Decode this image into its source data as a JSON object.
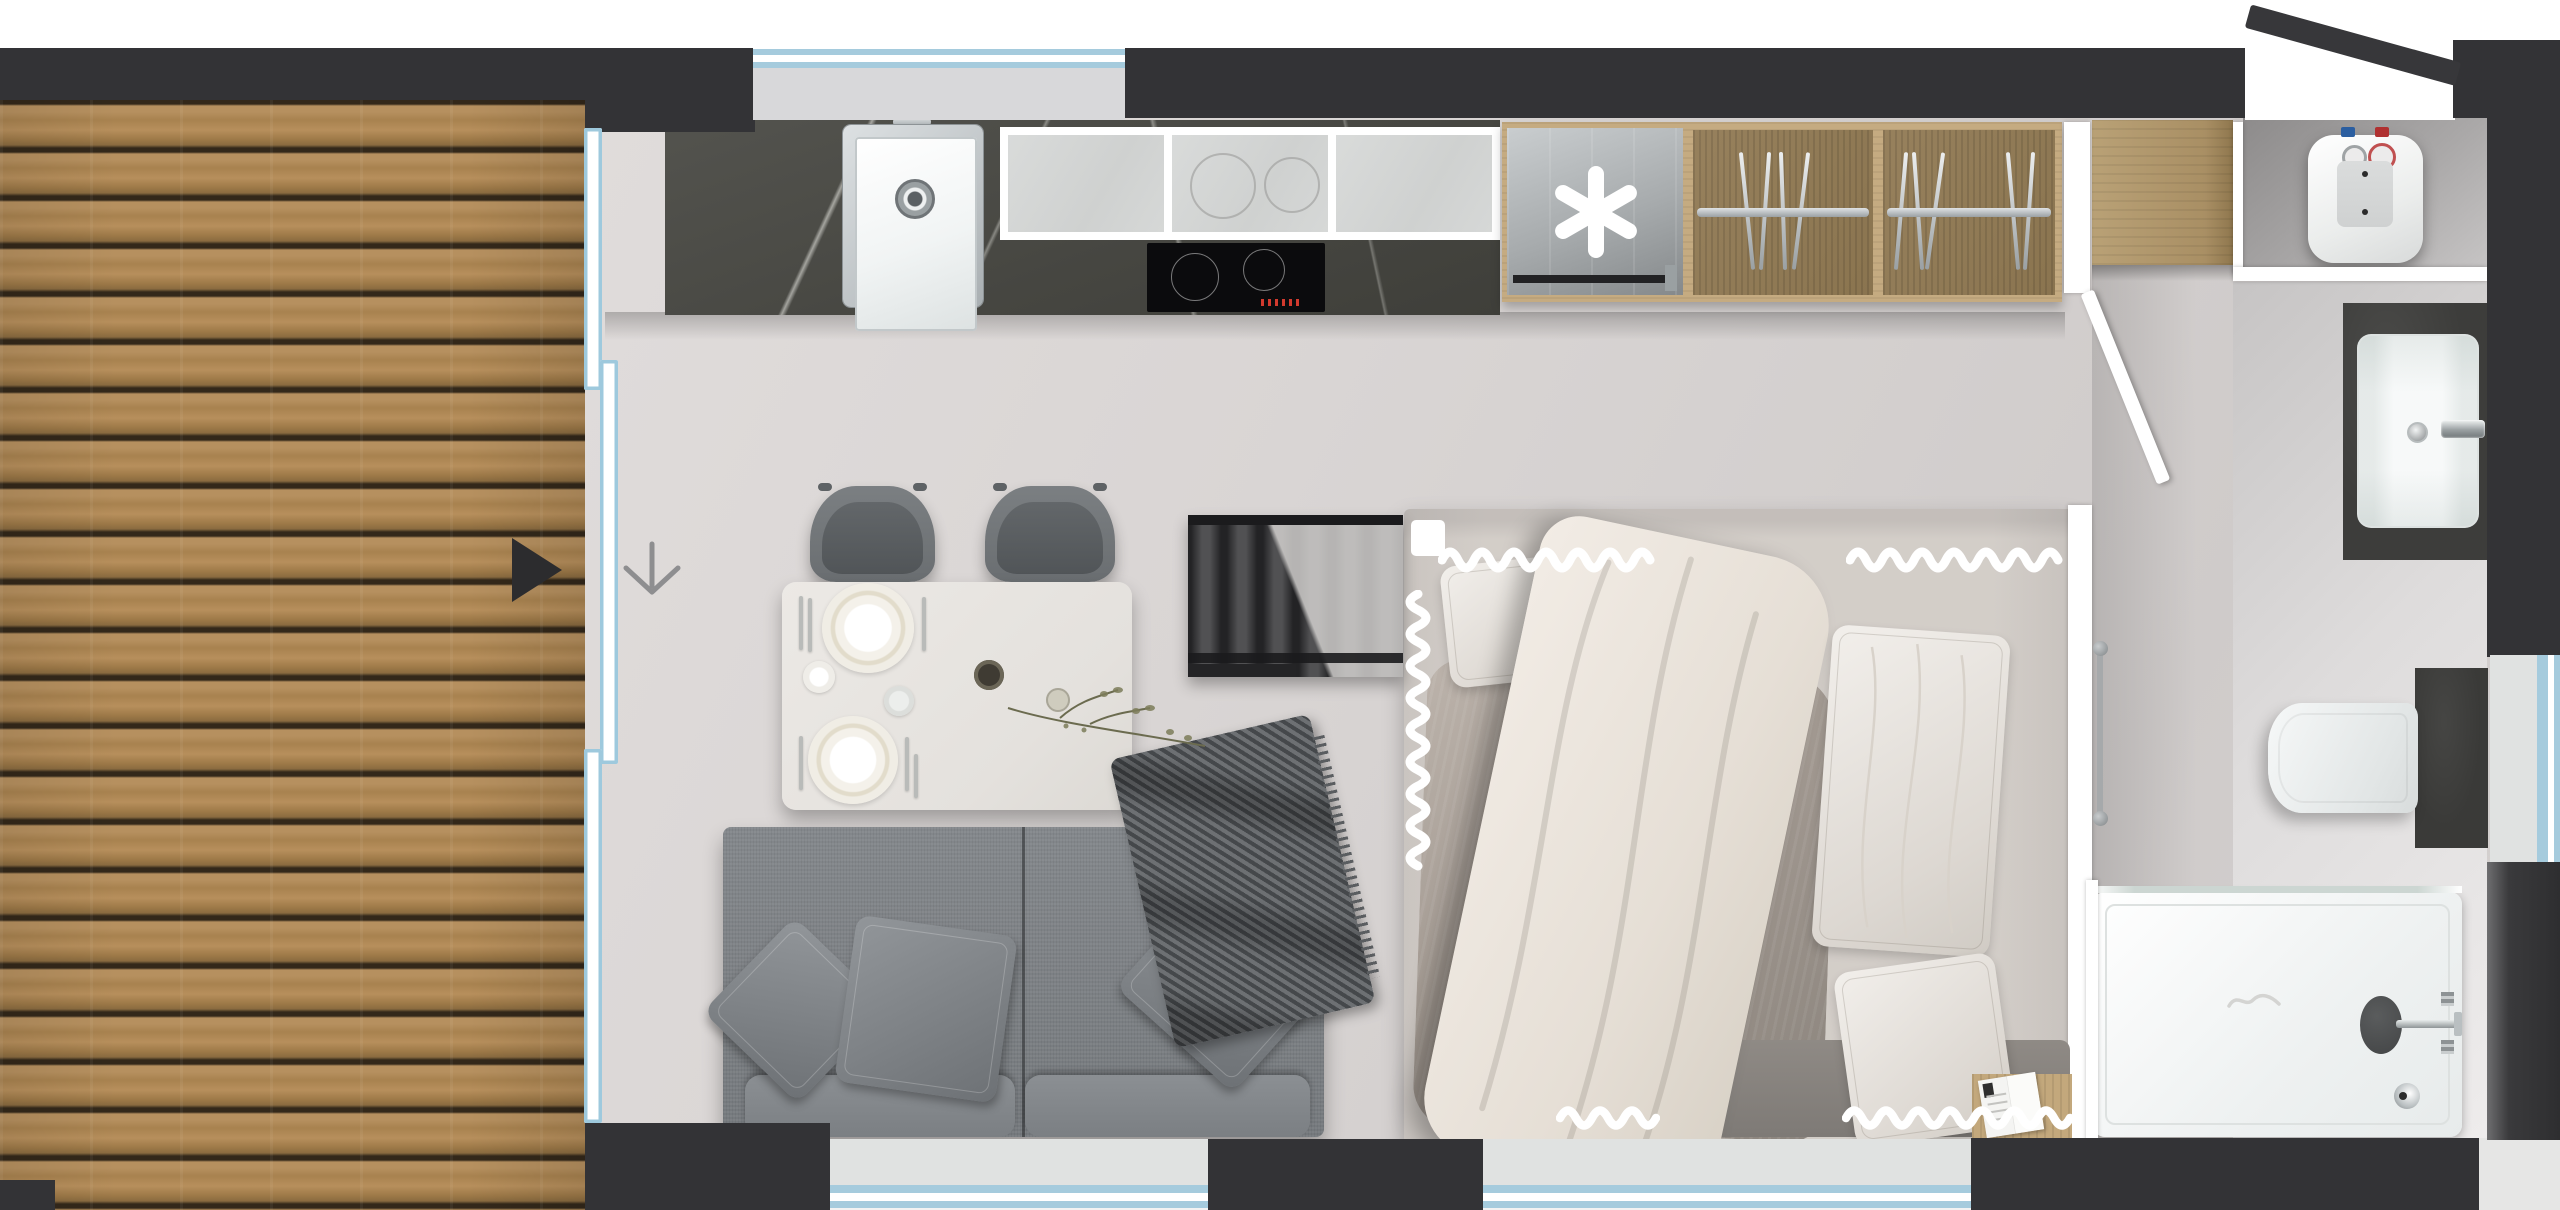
{
  "scene": {
    "type": "apartment-floor-plan-render",
    "view": "top-down",
    "width_px": 2560,
    "height_px": 1210,
    "visible_text": "none"
  },
  "colors": {
    "wall": "#333336",
    "window_accent": "#a5cbdd",
    "window_sill": "#dfe1e0",
    "deck_plank": "#b6905f",
    "deck_gap": "#33281a",
    "floor": "#dbd7d5",
    "counter_marble": "#464641",
    "backsplash_panel": "#d3d5d4",
    "hob": "#0b0b0d",
    "stainless": "#c8ccce",
    "cabinet_wood": "#c5ab81",
    "wardrobe_back": "#97815d",
    "sofa": "#7d8185",
    "chair": "#73777a",
    "table": "#e9e6e2",
    "bed_sheet": "#e7e4e1",
    "duvet": "#ece6de",
    "bed_blanket": "#a39a92",
    "radiator": "#232325",
    "bath_fixture_dark": "#3d3d3b",
    "shower_tray": "#f4f6f6",
    "white": "#ffffff"
  },
  "icons": {
    "appliance_symbol": {
      "name": "six-arm-asterisk-icon",
      "glyph": "✱"
    },
    "entry_arrow": {
      "name": "entry-arrow-icon",
      "glyph": "▶"
    },
    "walk_direction_arrow": {
      "name": "down-arrow-icon",
      "glyph": "↓"
    }
  },
  "rooms": [
    {
      "label": "terrace-deck"
    },
    {
      "label": "living-kitchen-area"
    },
    {
      "label": "sleeping-area"
    },
    {
      "label": "hallway"
    },
    {
      "label": "bathroom"
    },
    {
      "label": "water-heater-closet"
    }
  ],
  "fixtures": [
    {
      "label": "kitchen-counter-marble"
    },
    {
      "label": "undermount-sink"
    },
    {
      "label": "induction-hob"
    },
    {
      "label": "glass-backsplash-panels"
    },
    {
      "label": "dishwasher-with-asterisk"
    },
    {
      "label": "wardrobe-with-hangers"
    },
    {
      "label": "hall-cabinet"
    },
    {
      "label": "sliding-glass-door"
    },
    {
      "label": "entrance-door-open"
    },
    {
      "label": "interior-door-open"
    },
    {
      "label": "water-heater"
    },
    {
      "label": "washbasin-vanity"
    },
    {
      "label": "wall-hung-toilet"
    },
    {
      "label": "shower-tray-with-glass"
    },
    {
      "label": "double-bed"
    },
    {
      "label": "radiator"
    },
    {
      "label": "dining-table-set-for-two"
    },
    {
      "label": "two-chairs"
    },
    {
      "label": "two-seat-sofa"
    },
    {
      "label": "throw-blanket"
    },
    {
      "label": "open-book"
    },
    {
      "label": "towel-rail"
    }
  ]
}
